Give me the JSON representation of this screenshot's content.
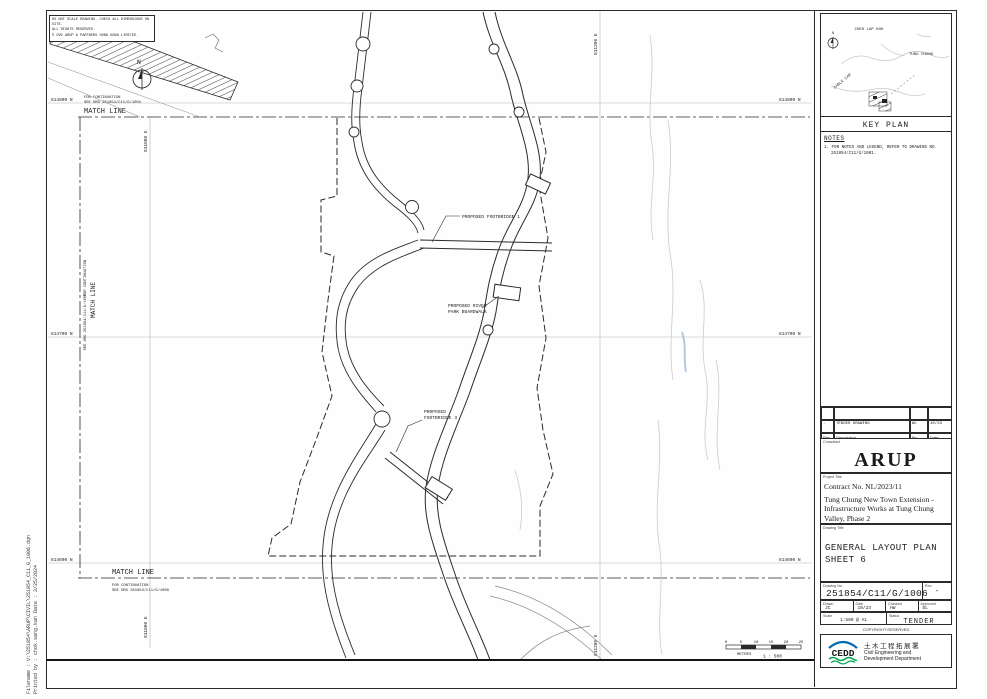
{
  "colors": {
    "line": "#2a2a2a",
    "faint_contour": "#c9c9c9",
    "blue_mark": "#9fbcd8",
    "cedd_blue": "#0067b1",
    "cedd_navy": "#00437a",
    "cedd_green": "#00a650"
  },
  "margin": {
    "filename": "Filename :    V:\\251854\\ARUP\\CIVIL\\251854_C11_G_1006.dgn",
    "printed_by": "Printed by :  chok.sang.kan        Date :  3/25/2024"
  },
  "disclaimer": {
    "line1": "DO NOT SCALE DRAWING. CHECK ALL DIMENSIONS ON SITE.",
    "line2": "ALL RIGHTS RESERVED.",
    "line3": "© OVE ARUP & PARTNERS HONG KONG LIMITED."
  },
  "plan": {
    "north": "N",
    "match_line": "MATCH LINE",
    "cont_top_1": "FOR CONTINUATION",
    "cont_top_2": "SEE DRG 251854/C11/G/1004",
    "cont_bottom_1": "FOR CONTINUATION",
    "cont_bottom_2": "SEE DRG 251854/C11/G/1008",
    "cont_left_1": "FOR CONTINUATION",
    "cont_left_2": "SEE DRG 251854/C11/G/1005",
    "grid": {
      "n1": "814800 N",
      "n2": "814700 N",
      "n3": "814600 N",
      "e1": "811000 E",
      "e2": "811200 E"
    },
    "labels": {
      "footbridge1": "PROPOSED FOOTBRIDGE 1",
      "boardwalk_1": "PROPOSED RIVER",
      "boardwalk_2": "PARK BOARDWALK",
      "footbridge3_1": "PROPOSED",
      "footbridge3_2": "FOOTBRIDGE 3"
    },
    "scale_bar": {
      "t0": "0",
      "t1": "5",
      "t2": "10",
      "t3": "15",
      "t4": "20",
      "t5": "25",
      "unit": "METRES",
      "ratio": "1 : 500"
    }
  },
  "title_block": {
    "key_plan": {
      "title": "KEY PLAN",
      "north": "N",
      "label_airport": "CHEK LAP KOK",
      "label_town": "TUNG CHUNG",
      "label_cable": "CABLE CAR"
    },
    "notes": {
      "heading": "NOTES",
      "item1a": "1. FOR NOTES AND LEGEND, REFER TO DRAWING NO.",
      "item1b": "251854/C11/G/1001."
    },
    "revisions": {
      "rows": [
        {
          "rev": "-",
          "description": "TENDER DRAWING",
          "by": "WL",
          "date": "10/23"
        }
      ],
      "header": {
        "rev": "Rev",
        "description": "Description",
        "by": "By",
        "date": "Date"
      }
    },
    "consultant": {
      "label": "Consultant",
      "name": "ARUP"
    },
    "project": {
      "label": "Project Title",
      "contract": "Contract No. NL/2023/11",
      "line1": "Tung Chung New Town Extension -",
      "line2": "Infrastructure Works at Tung Chung",
      "line3": "Valley, Phase 2"
    },
    "drawing": {
      "label": "Drawing Title",
      "line1": "GENERAL LAYOUT PLAN",
      "line2": "SHEET 6"
    },
    "number": {
      "label": "Drawing No.",
      "value": "251854/C11/G/1006",
      "rev_label": "Rev.",
      "rev_value": "-"
    },
    "signoff": {
      "drawn_label": "Drawn",
      "drawn": "JC",
      "date_label": "Date",
      "date": "10/23",
      "checked_label": "Checked",
      "checked": "HW",
      "approved_label": "Approved",
      "approved": "DL"
    },
    "scale": {
      "label": "Scale",
      "value": "1:500 @ A1",
      "status_label": "Status",
      "status": "TENDER"
    },
    "copyright": "COPYRIGHT RESERVED",
    "department": {
      "acronym": "CEDD",
      "chinese": "土木工程拓展署",
      "english1": "Civil Engineering and",
      "english2": "Development Department"
    }
  }
}
